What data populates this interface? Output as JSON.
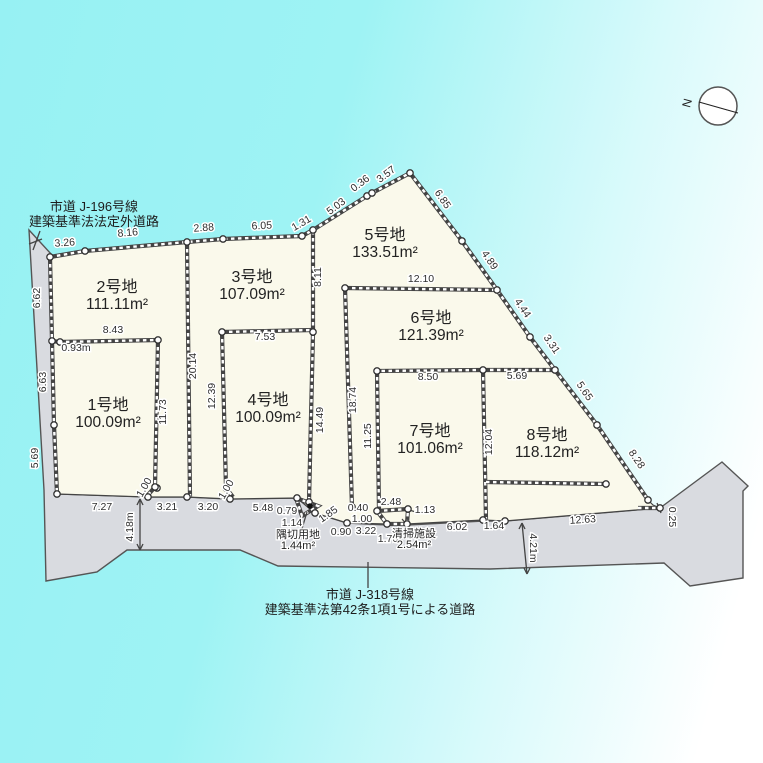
{
  "title": "分譲地区画図",
  "colors": {
    "background_cyan": "#98f2f3",
    "background_white": "#ffffff",
    "parcel_fill": "#faf9eb",
    "road_fill": "#d9dbe0",
    "line": "#444444",
    "text": "#2e2e2e"
  },
  "compass": {
    "label": "N"
  },
  "roads": {
    "top": {
      "lines": [
        "市道 J-196号線",
        "建築基準法法定外道路"
      ],
      "x": 94,
      "y": 211
    },
    "bottom": {
      "lines": [
        "市道 J-318号線",
        "建築基準法第42条1項1号による道路"
      ],
      "x": 370,
      "y": 599
    }
  },
  "plots": [
    {
      "name": "1号地",
      "area": "100.09m²",
      "x": 108,
      "y": 410
    },
    {
      "name": "2号地",
      "area": "111.11m²",
      "x": 117,
      "y": 292
    },
    {
      "name": "3号地",
      "area": "107.09m²",
      "x": 252,
      "y": 282
    },
    {
      "name": "4号地",
      "area": "100.09m²",
      "x": 268,
      "y": 405
    },
    {
      "name": "5号地",
      "area": "133.51m²",
      "x": 385,
      "y": 240
    },
    {
      "name": "6号地",
      "area": "121.39m²",
      "x": 431,
      "y": 323
    },
    {
      "name": "7号地",
      "area": "101.06m²",
      "x": 430,
      "y": 436
    },
    {
      "name": "8号地",
      "area": "118.12m²",
      "x": 547,
      "y": 440
    }
  ],
  "special_areas": [
    {
      "name": "隅切用地",
      "area": "1.44m²",
      "x": 298,
      "y": 538
    },
    {
      "name": "清掃施設",
      "area": "2.54m²",
      "x": 414,
      "y": 537
    }
  ],
  "dims": [
    {
      "t": "3.26",
      "x": 65,
      "y": 246,
      "r": -4
    },
    {
      "t": "8.16",
      "x": 128,
      "y": 236,
      "r": -5
    },
    {
      "t": "2.88",
      "x": 204,
      "y": 231,
      "r": -4
    },
    {
      "t": "6.05",
      "x": 262,
      "y": 229,
      "r": -3
    },
    {
      "t": "1.31",
      "x": 303,
      "y": 226,
      "r": -30
    },
    {
      "t": "5.03",
      "x": 338,
      "y": 209,
      "r": -37
    },
    {
      "t": "0.36",
      "x": 362,
      "y": 186,
      "r": -37
    },
    {
      "t": "3.57",
      "x": 388,
      "y": 177,
      "r": -37
    },
    {
      "t": "6.85",
      "x": 440,
      "y": 201,
      "r": 56
    },
    {
      "t": "4.89",
      "x": 487,
      "y": 262,
      "r": 56
    },
    {
      "t": "4.44",
      "x": 520,
      "y": 310,
      "r": 56
    },
    {
      "t": "3.31",
      "x": 549,
      "y": 346,
      "r": 56
    },
    {
      "t": "5.65",
      "x": 582,
      "y": 393,
      "r": 56
    },
    {
      "t": "8.28",
      "x": 634,
      "y": 461,
      "r": 56
    },
    {
      "t": "0.25",
      "x": 669,
      "y": 517,
      "r": 90
    },
    {
      "t": "6.62",
      "x": 40,
      "y": 298,
      "r": -90
    },
    {
      "t": "6.63",
      "x": 46,
      "y": 382,
      "r": -90
    },
    {
      "t": "5.69",
      "x": 38,
      "y": 458,
      "r": -90
    },
    {
      "t": "0.93m",
      "x": 76,
      "y": 351,
      "r": 0
    },
    {
      "t": "8.43",
      "x": 113,
      "y": 333,
      "r": 0
    },
    {
      "t": "11.73",
      "x": 166,
      "y": 412,
      "r": -90
    },
    {
      "t": "20.14",
      "x": 196,
      "y": 366,
      "r": -90
    },
    {
      "t": "12.39",
      "x": 215,
      "y": 396,
      "r": -90
    },
    {
      "t": "7.53",
      "x": 265,
      "y": 340,
      "r": 0
    },
    {
      "t": "8.11",
      "x": 321,
      "y": 277,
      "r": -90
    },
    {
      "t": "14.49",
      "x": 323,
      "y": 420,
      "r": -90
    },
    {
      "t": "18.74",
      "x": 356,
      "y": 400,
      "r": -90
    },
    {
      "t": "12.10",
      "x": 421,
      "y": 282,
      "r": 0
    },
    {
      "t": "8.50",
      "x": 428,
      "y": 380,
      "r": 0
    },
    {
      "t": "11.25",
      "x": 371,
      "y": 436,
      "r": -90
    },
    {
      "t": "12.04",
      "x": 492,
      "y": 442,
      "r": -90
    },
    {
      "t": "5.69",
      "x": 517,
      "y": 379,
      "r": 0
    },
    {
      "t": "7.27",
      "x": 102,
      "y": 510,
      "r": 0
    },
    {
      "t": "1.00",
      "x": 147,
      "y": 489,
      "r": -60
    },
    {
      "t": "3.21",
      "x": 167,
      "y": 510,
      "r": 0
    },
    {
      "t": "3.20",
      "x": 208,
      "y": 510,
      "r": 0
    },
    {
      "t": "1.00",
      "x": 229,
      "y": 491,
      "r": -60
    },
    {
      "t": "5.48",
      "x": 263,
      "y": 511,
      "r": 0
    },
    {
      "t": "0.79",
      "x": 287,
      "y": 514,
      "r": 0
    },
    {
      "t": "1.14",
      "x": 292,
      "y": 526,
      "r": 0
    },
    {
      "t": "1.85",
      "x": 330,
      "y": 517,
      "r": -35
    },
    {
      "t": "0.90",
      "x": 341,
      "y": 535,
      "r": 0
    },
    {
      "t": "3.22",
      "x": 366,
      "y": 534,
      "r": 0
    },
    {
      "t": "0.40",
      "x": 358,
      "y": 511,
      "r": 0
    },
    {
      "t": "1.00",
      "x": 362,
      "y": 522,
      "r": 0
    },
    {
      "t": "2.48",
      "x": 391,
      "y": 505,
      "r": 0
    },
    {
      "t": "1.13",
      "x": 425,
      "y": 513,
      "r": 0
    },
    {
      "t": "1.76",
      "x": 388,
      "y": 542,
      "r": 0
    },
    {
      "t": "6.02",
      "x": 457,
      "y": 530,
      "r": 0
    },
    {
      "t": "1.64",
      "x": 494,
      "y": 529,
      "r": 0
    },
    {
      "t": "12.63",
      "x": 583,
      "y": 523,
      "r": -4
    },
    {
      "t": "4.18m",
      "x": 133,
      "y": 527,
      "r": -90
    },
    {
      "t": "4.21m",
      "x": 530,
      "y": 548,
      "r": 90
    }
  ],
  "geometry": {
    "road_polygon": [
      [
        29,
        230
      ],
      [
        52,
        255
      ],
      [
        57,
        494
      ],
      [
        148,
        497
      ],
      [
        187,
        497
      ],
      [
        230,
        499
      ],
      [
        297,
        498
      ],
      [
        315,
        513
      ],
      [
        347,
        523
      ],
      [
        387,
        525
      ],
      [
        407,
        525
      ],
      [
        483,
        521
      ],
      [
        505,
        521
      ],
      [
        660,
        508
      ],
      [
        722,
        462
      ],
      [
        748,
        486
      ],
      [
        743,
        491
      ],
      [
        743,
        578
      ],
      [
        690,
        586
      ],
      [
        664,
        563
      ],
      [
        490,
        569
      ],
      [
        278,
        566
      ],
      [
        240,
        550
      ],
      [
        127,
        550
      ],
      [
        97,
        572
      ],
      [
        46,
        581
      ],
      [
        44,
        490
      ]
    ],
    "parcel_polygon": [
      [
        50,
        257
      ],
      [
        85,
        251
      ],
      [
        187,
        242
      ],
      [
        223,
        239
      ],
      [
        302,
        236
      ],
      [
        313,
        230
      ],
      [
        367,
        196
      ],
      [
        372,
        193
      ],
      [
        410,
        173
      ],
      [
        462,
        241
      ],
      [
        497,
        290
      ],
      [
        530,
        337
      ],
      [
        555,
        370
      ],
      [
        597,
        425
      ],
      [
        648,
        500
      ],
      [
        653,
        505
      ],
      [
        660,
        508
      ],
      [
        505,
        521
      ],
      [
        483,
        520
      ],
      [
        407,
        524
      ],
      [
        387,
        524
      ],
      [
        347,
        523
      ],
      [
        315,
        513
      ],
      [
        297,
        498
      ],
      [
        230,
        499
      ],
      [
        187,
        497
      ],
      [
        148,
        497
      ],
      [
        57,
        494
      ]
    ],
    "ladder_lines": [
      [
        [
          50,
          257
        ],
        [
          85,
          251
        ],
        [
          187,
          242
        ],
        [
          223,
          239
        ],
        [
          302,
          236
        ],
        [
          313,
          230
        ],
        [
          367,
          196
        ],
        [
          372,
          193
        ],
        [
          410,
          173
        ],
        [
          462,
          241
        ],
        [
          497,
          290
        ],
        [
          530,
          337
        ],
        [
          555,
          370
        ],
        [
          597,
          425
        ],
        [
          648,
          500
        ]
      ],
      [
        [
          50,
          257
        ],
        [
          52,
          341
        ],
        [
          54,
          425
        ],
        [
          57,
          494
        ]
      ],
      [
        [
          187,
          242
        ],
        [
          190,
          497
        ]
      ],
      [
        [
          52,
          341
        ],
        [
          60,
          342
        ],
        [
          158,
          340
        ]
      ],
      [
        [
          158,
          340
        ],
        [
          155,
          487
        ],
        [
          147,
          496
        ]
      ],
      [
        [
          222,
          332
        ],
        [
          226,
          488
        ],
        [
          233,
          497
        ]
      ],
      [
        [
          222,
          332
        ],
        [
          313,
          330
        ]
      ],
      [
        [
          313,
          231
        ],
        [
          313,
          333
        ],
        [
          309,
          502
        ]
      ],
      [
        [
          345,
          288
        ],
        [
          352,
          507
        ]
      ],
      [
        [
          345,
          288
        ],
        [
          497,
          290
        ]
      ],
      [
        [
          483,
          370
        ],
        [
          377,
          371
        ],
        [
          379,
          511
        ]
      ],
      [
        [
          483,
          370
        ],
        [
          486,
          520
        ]
      ],
      [
        [
          483,
          370
        ],
        [
          555,
          370
        ]
      ],
      [
        [
          486,
          482
        ],
        [
          606,
          484
        ]
      ],
      [
        [
          638,
          508
        ],
        [
          661,
          508
        ]
      ],
      [
        [
          377,
          511
        ],
        [
          408,
          509
        ],
        [
          407,
          524
        ],
        [
          387,
          524
        ],
        [
          377,
          511
        ]
      ],
      [
        [
          296,
          498
        ],
        [
          318,
          506
        ],
        [
          302,
          516
        ],
        [
          296,
          498
        ]
      ]
    ],
    "thin_lines": [
      [
        [
          40,
          231
        ],
        [
          33,
          250
        ]
      ],
      [
        [
          29,
          244
        ],
        [
          42,
          239
        ]
      ],
      [
        [
          368,
          562
        ],
        [
          368,
          588
        ]
      ],
      [
        [
          416,
          512
        ],
        [
          409,
          510
        ]
      ],
      [
        [
          301,
          532
        ],
        [
          307,
          512
        ]
      ],
      [
        [
          414,
          533
        ],
        [
          402,
          519
        ]
      ],
      [
        [
          140,
          499
        ],
        [
          140,
          550
        ]
      ],
      [
        [
          140,
          499
        ],
        [
          137,
          505
        ]
      ],
      [
        [
          140,
          499
        ],
        [
          143,
          505
        ]
      ],
      [
        [
          140,
          550
        ],
        [
          137,
          544
        ]
      ],
      [
        [
          140,
          550
        ],
        [
          143,
          544
        ]
      ],
      [
        [
          522,
          523
        ],
        [
          527,
          574
        ]
      ],
      [
        [
          522,
          523
        ],
        [
          519,
          529
        ]
      ],
      [
        [
          522,
          523
        ],
        [
          525,
          529
        ]
      ],
      [
        [
          527,
          574
        ],
        [
          524,
          568
        ]
      ],
      [
        [
          527,
          574
        ],
        [
          530,
          568
        ]
      ],
      [
        [
          657,
          503
        ],
        [
          661,
          513
        ]
      ]
    ],
    "circles": [
      [
        50,
        257
      ],
      [
        85,
        251
      ],
      [
        187,
        242
      ],
      [
        223,
        239
      ],
      [
        302,
        236
      ],
      [
        313,
        230
      ],
      [
        367,
        196
      ],
      [
        372,
        193
      ],
      [
        410,
        173
      ],
      [
        462,
        241
      ],
      [
        497,
        290
      ],
      [
        530,
        337
      ],
      [
        555,
        370
      ],
      [
        597,
        425
      ],
      [
        648,
        500
      ],
      [
        660,
        508
      ],
      [
        52,
        341
      ],
      [
        54,
        425
      ],
      [
        57,
        494
      ],
      [
        148,
        497
      ],
      [
        157,
        488
      ],
      [
        187,
        497
      ],
      [
        230,
        499
      ],
      [
        297,
        498
      ],
      [
        315,
        513
      ],
      [
        347,
        523
      ],
      [
        387,
        524
      ],
      [
        407,
        524
      ],
      [
        408,
        509
      ],
      [
        377,
        511
      ],
      [
        483,
        520
      ],
      [
        505,
        521
      ],
      [
        60,
        342
      ],
      [
        158,
        340
      ],
      [
        155,
        487
      ],
      [
        222,
        332
      ],
      [
        226,
        488
      ],
      [
        313,
        332
      ],
      [
        345,
        288
      ],
      [
        377,
        371
      ],
      [
        483,
        370
      ],
      [
        606,
        484
      ],
      [
        352,
        507
      ],
      [
        309,
        502
      ]
    ],
    "dots": [
      [
        310,
        506
      ]
    ],
    "compass": {
      "cx": 718,
      "cy": 106,
      "r": 19,
      "needle": [
        [
          699,
          102
        ],
        [
          738,
          113
        ],
        [
          726,
          110
        ]
      ],
      "n_x": 691,
      "n_y": 104,
      "n_rot": -75
    }
  }
}
